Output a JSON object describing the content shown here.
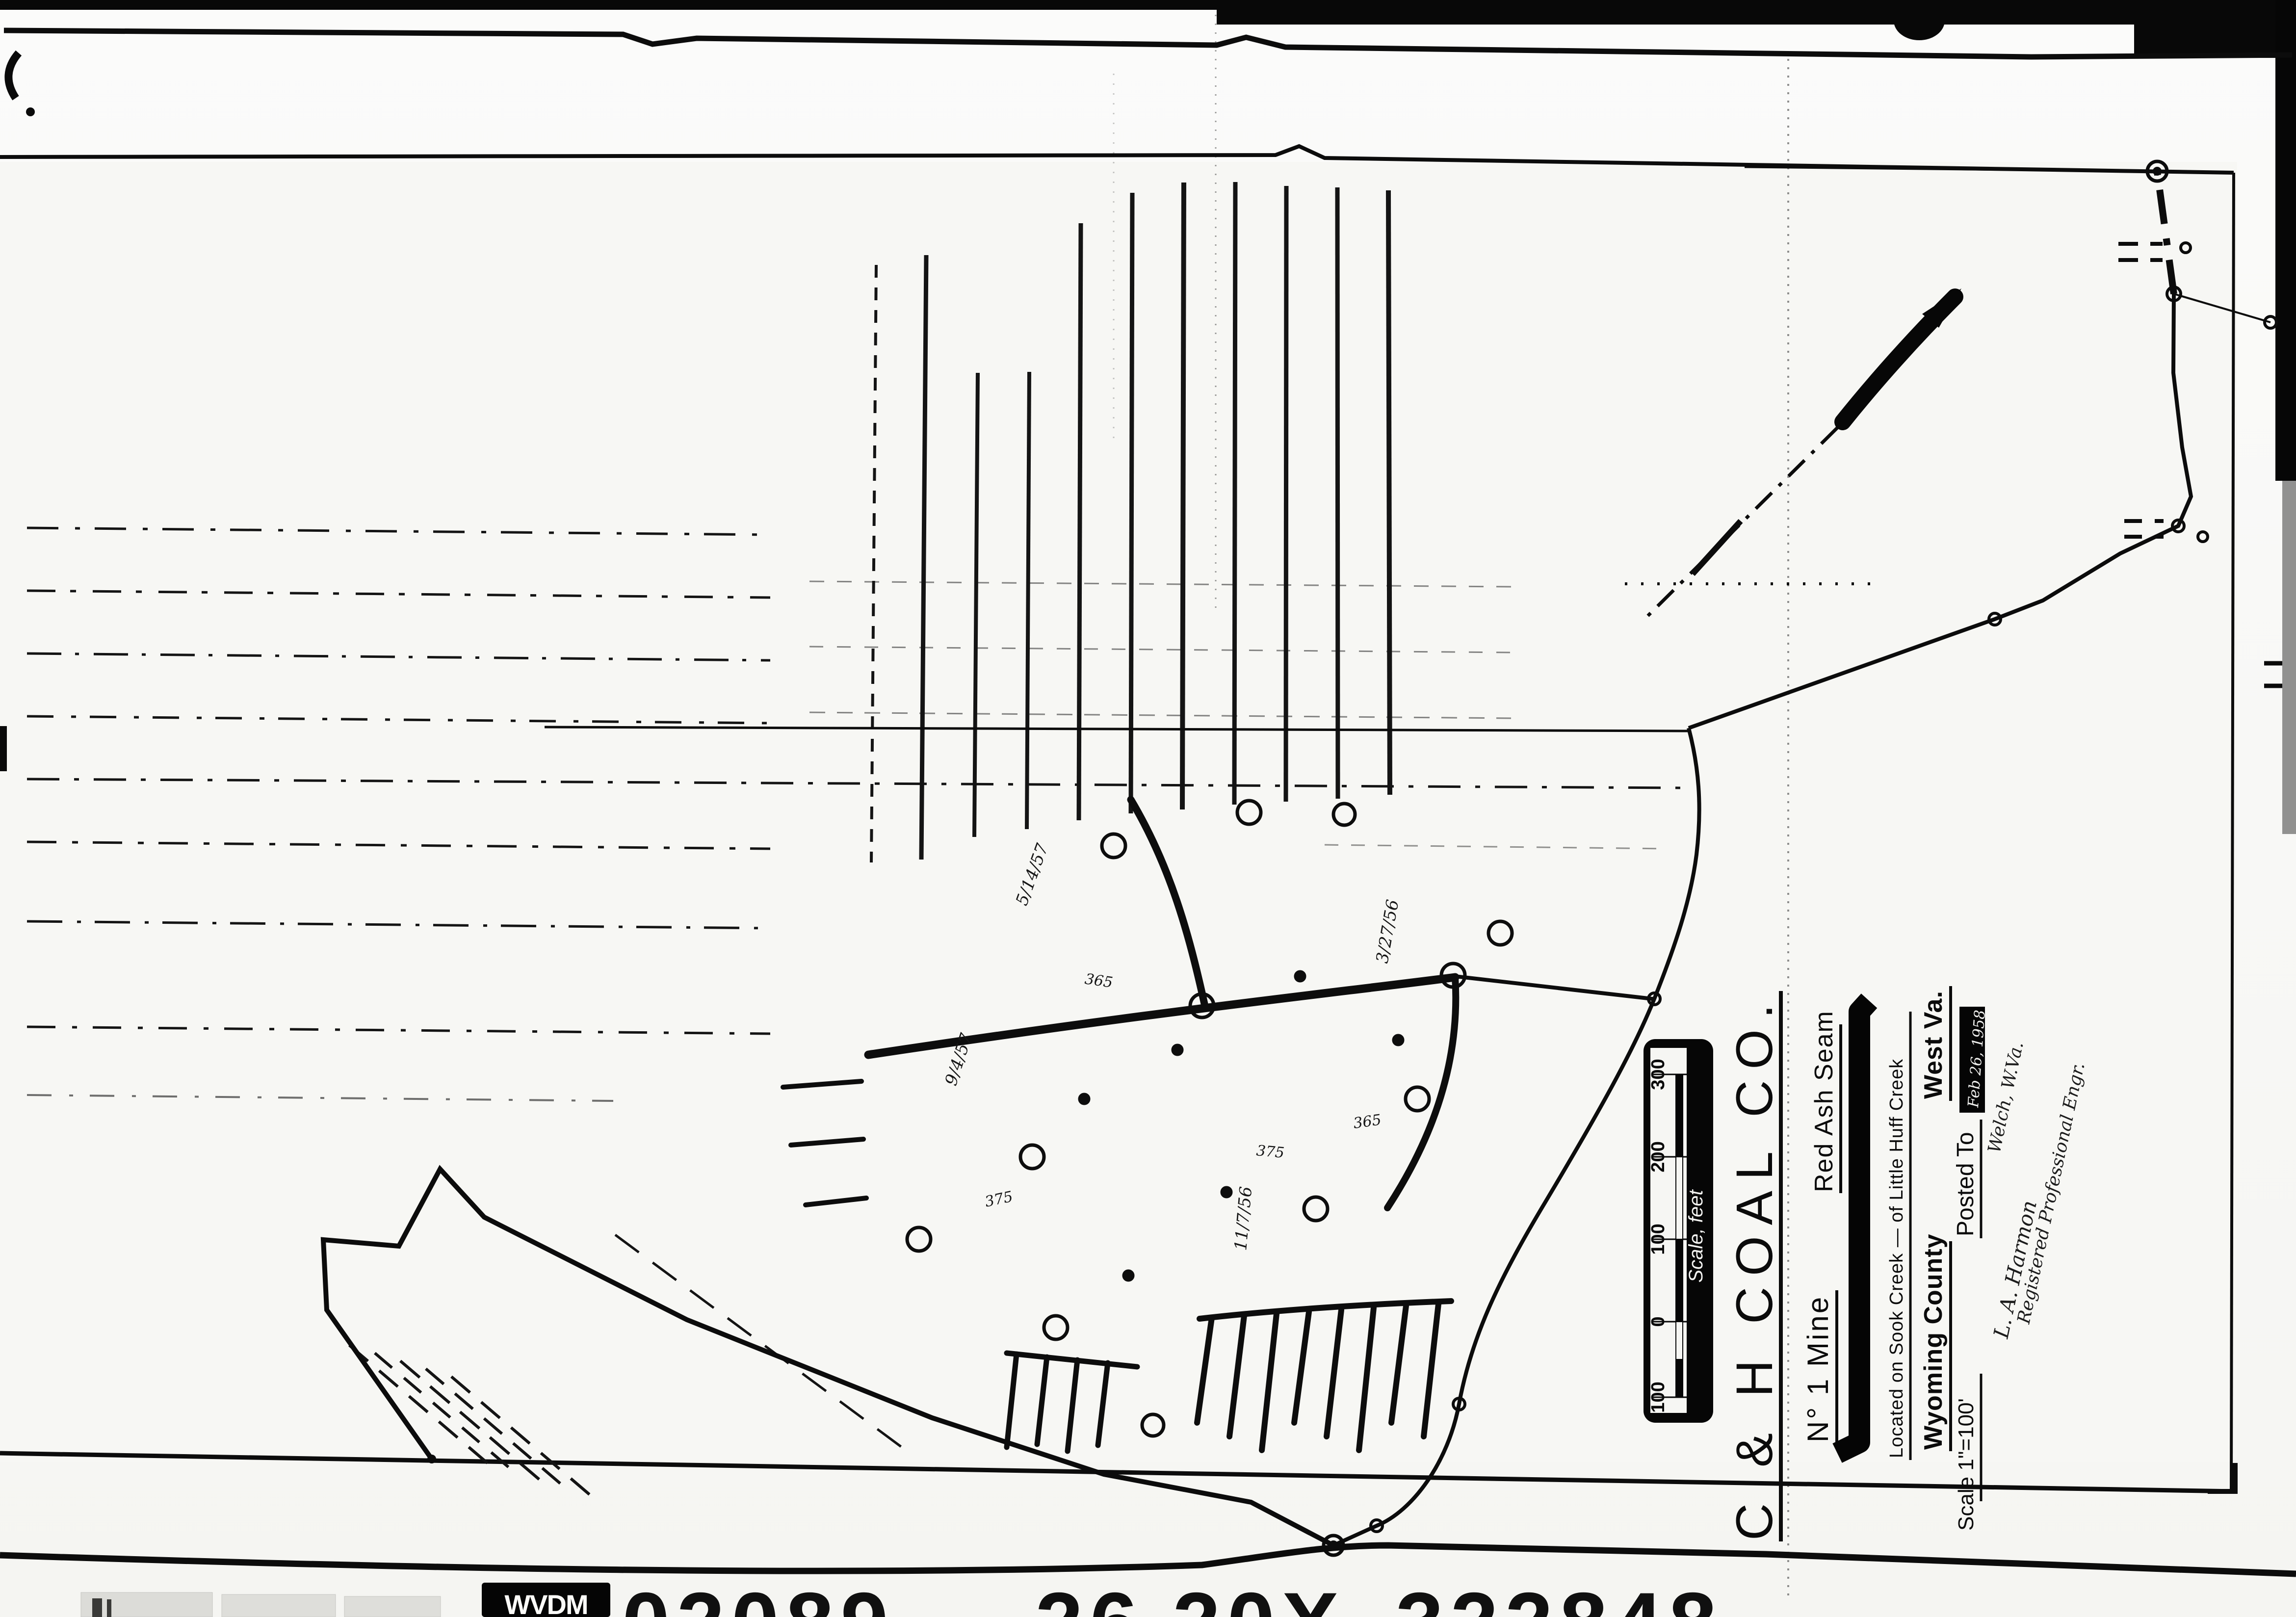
{
  "map": {
    "title_block": {
      "company": "C & H  COAL  CO.",
      "mine": "N° 1 Mine",
      "seam": "Red Ash Seam",
      "location": "Located on Sook Creek — of Little Huff Creek",
      "county": "Wyoming County",
      "state": "West Va.",
      "scale": "Scale 1\"=100'",
      "posted_label": "Posted To",
      "posted_date": "Feb 26, 1958",
      "engineer_name": "L. A. Harmon",
      "engineer_title": "Registered Professional Engr.",
      "engineer_city": "Welch, W.Va."
    },
    "scale_bar": {
      "ticks": [
        "100",
        "0",
        "100",
        "200",
        "300"
      ],
      "caption": "Scale, feet"
    },
    "annotations": {
      "dates": [
        "3/27/56",
        "5/14/57",
        "9/4/57",
        "11/7/56"
      ],
      "elevations": [
        "365",
        "375"
      ]
    },
    "texture_glyphs": [
      "6",
      "9",
      "4",
      "7"
    ]
  },
  "stamp": {
    "agency": "WVDM",
    "doc_number": "02089",
    "sheet_number": "26",
    "code": "20X",
    "file_number": "322848"
  },
  "colors": {
    "ink": "#0d0d0d",
    "paper": "#f8f8f5"
  }
}
